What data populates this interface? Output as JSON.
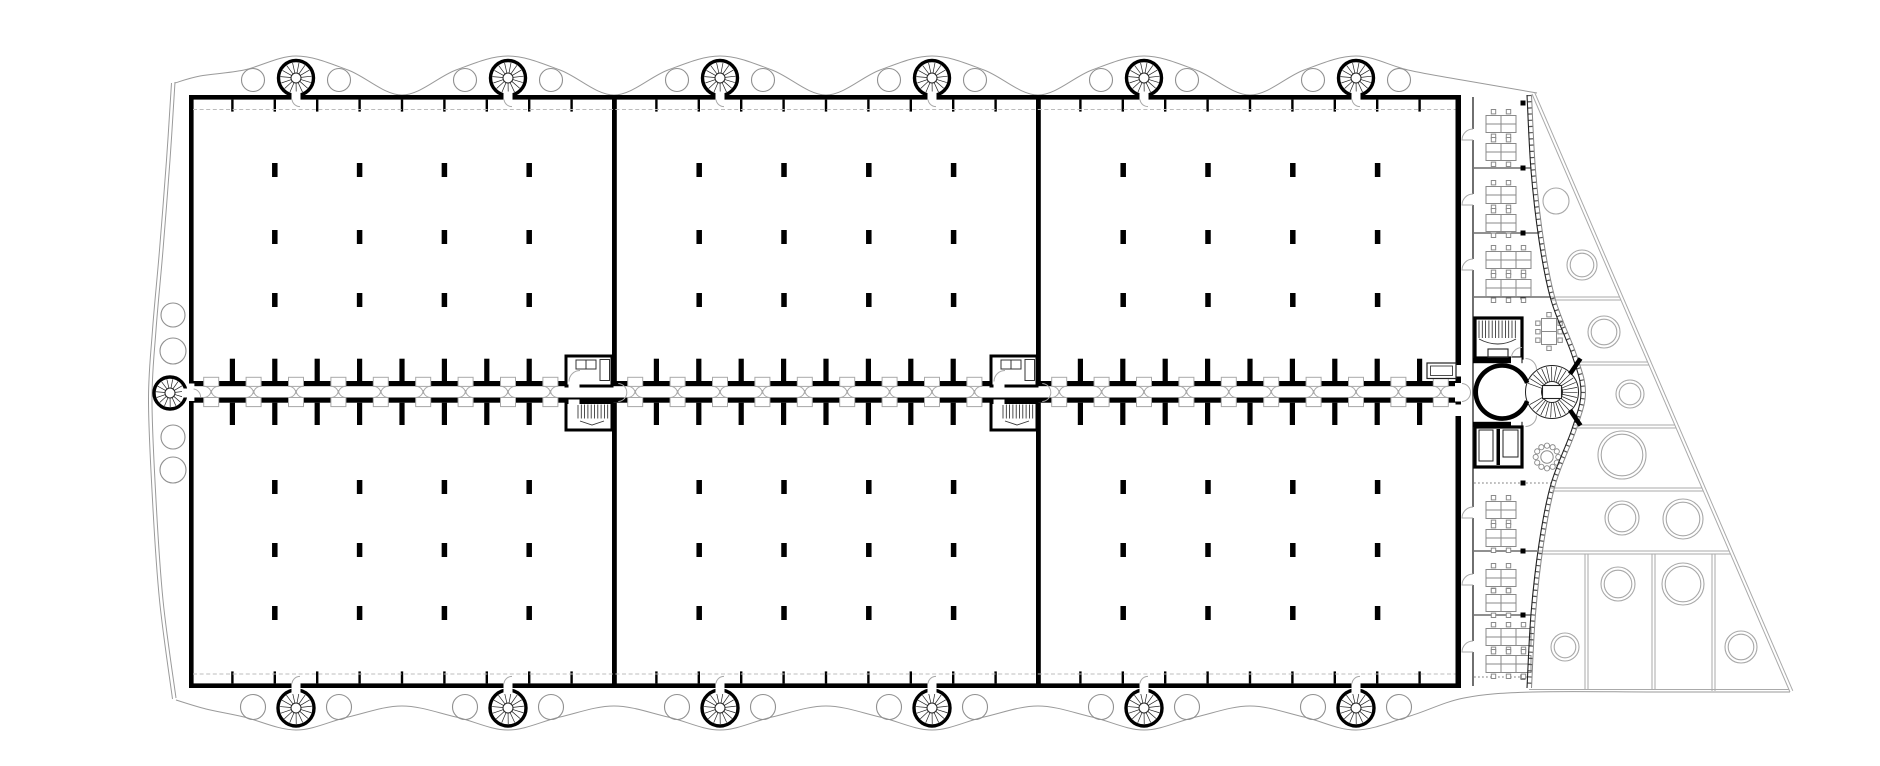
{
  "drawing": {
    "kind": "architectural-floor-plan",
    "canvas": {
      "w": 1880,
      "h": 766,
      "bg": "#ffffff"
    },
    "colors": {
      "wall": "#000000",
      "thin_line": "#222222",
      "fixture": "#333333",
      "door": "#a8a8a8",
      "furniture": "#8a8a8a",
      "landscape": "#9a9a9a",
      "tree_circle": "#909090",
      "plot_circle": "#a8a8a8",
      "dashed": "#bcbcbc",
      "dotted": "#808080",
      "facade_dark": "#222222",
      "facade_mid": "#555555",
      "facade_light": "#888888"
    },
    "grid": {
      "x0": 190,
      "spacing": 42.4,
      "bays": 30
    },
    "shell": {
      "left": 189,
      "right": 1458,
      "top": 95,
      "bottom": 688,
      "wall_t": 4.6,
      "east_wall_x": 1455.5,
      "east_wall_t": 5.5,
      "dividers_x": [
        612,
        1036
      ],
      "divider_t": 4.8,
      "tick_len": 12,
      "tick_w": 2.4,
      "dash_top_y": 109.5,
      "dash_bottom_y": 674
    },
    "corridor": {
      "wall_top_y": 381,
      "wall_bot_y": 397.5,
      "wall_t": 5.2,
      "stub_len": 22.3,
      "stub_w": 5.2,
      "door_half_w": 7.5,
      "skip_door_bays": [
        9,
        19
      ],
      "skip_stub_idx": [
        9,
        10,
        19,
        20
      ],
      "west_opening": {
        "x": 188.2,
        "y": 383.5,
        "w": 6.2,
        "h": 17.5
      }
    },
    "columns": {
      "w": 5.5,
      "h": 14,
      "rows_y": [
        170,
        237,
        300,
        487,
        550,
        613
      ],
      "grid_offsets": [
        2,
        4,
        6,
        8
      ],
      "hall_origins_x": [
        190,
        614.4,
        1038.4
      ]
    },
    "cores": {
      "x_list": [
        566,
        991
      ],
      "w": 46,
      "room_y": 356,
      "room_h": 30,
      "stair_y": 402.5,
      "stair_h": 27.5
    },
    "east_wing": {
      "strip_wall_x": 1473,
      "dots_x": 1520.5,
      "dots_y": [
        103,
        168,
        233,
        297,
        483,
        551,
        615,
        677
      ],
      "partitions": [
        {
          "y": 168,
          "x2": 1531.5
        },
        {
          "y": 233,
          "x2": 1539.5
        },
        {
          "y": 297,
          "x2": 1551
        },
        {
          "y": 551,
          "x2": 1537
        },
        {
          "y": 615,
          "x2": 1531
        }
      ],
      "dotted_partitions": [
        {
          "y": 483,
          "x2": 1551
        },
        {
          "y": 677,
          "x2": 1529
        }
      ],
      "rooms": [
        {
          "y0": 97,
          "y1": 168,
          "door_y": 140,
          "desks": [
            {
              "cy": 124,
              "u": 2
            },
            {
              "cy": 152,
              "u": 2
            }
          ]
        },
        {
          "y0": 168,
          "y1": 233,
          "door_y": 205,
          "desks": [
            {
              "cy": 195,
              "u": 2
            },
            {
              "cy": 223,
              "u": 2
            }
          ]
        },
        {
          "y0": 233,
          "y1": 297,
          "door_y": 270,
          "desks": [
            {
              "cy": 260,
              "u": 3
            },
            {
              "cy": 288,
              "u": 3
            }
          ]
        },
        {
          "y0": 483,
          "y1": 551,
          "door_y": 518,
          "desks": [
            {
              "cy": 510,
              "u": 2
            },
            {
              "cy": 538,
              "u": 2
            }
          ]
        },
        {
          "y0": 551,
          "y1": 615,
          "door_y": 585,
          "desks": [
            {
              "cy": 578,
              "u": 2
            },
            {
              "cy": 603,
              "u": 2
            }
          ]
        },
        {
          "y0": 615,
          "y1": 677,
          "door_y": 652,
          "desks": [
            {
              "cy": 637,
              "u": 3
            },
            {
              "cy": 664,
              "u": 3
            }
          ]
        }
      ],
      "stair_room": {
        "x": 1475,
        "y": 318,
        "w": 47,
        "h": 40
      },
      "wc_room": {
        "x": 1475,
        "y": 427,
        "w": 47,
        "h": 40
      },
      "lobby": {
        "wall_x": 1473,
        "wall_w": 49.5,
        "top_y": 358,
        "bot_y": 421.8,
        "wall_t": 5.2
      },
      "booth": {
        "x": 1427,
        "y": 363,
        "w": 29,
        "h": 15.5
      },
      "table8": {
        "x": 1541.5,
        "y": 318.5,
        "w": 15,
        "h": 26
      },
      "table12": {
        "cx": 1547,
        "cy": 457,
        "r_table": 6.2,
        "r_ring": 11.3,
        "r_chair": 2.6,
        "n": 12
      },
      "spiral": {
        "cx": 1552,
        "cy": 392,
        "r_out": 26.5,
        "r_in": 10.5,
        "lift": {
          "x": 1542.5,
          "y": 385.5,
          "w": 19,
          "h": 13
        }
      },
      "facade_pts": [
        [
          1527,
          95
        ],
        [
          1531,
          170
        ],
        [
          1539,
          240
        ],
        [
          1551,
          300
        ],
        [
          1572,
          355
        ],
        [
          1581,
          392
        ],
        [
          1572,
          429
        ],
        [
          1551,
          484
        ],
        [
          1539,
          544
        ],
        [
          1531,
          614
        ],
        [
          1527,
          688
        ]
      ]
    },
    "landscape": {
      "top_wave": [
        [
          175,
          83
        ],
        [
          200,
          76
        ],
        [
          244,
          70
        ],
        [
          296,
          56
        ],
        [
          348,
          70
        ],
        [
          402,
          95
        ],
        [
          456,
          70
        ],
        [
          508,
          56
        ],
        [
          560,
          70
        ],
        [
          614,
          95
        ],
        [
          668,
          70
        ],
        [
          720,
          56
        ],
        [
          772,
          70
        ],
        [
          826,
          95
        ],
        [
          880,
          70
        ],
        [
          932,
          56
        ],
        [
          984,
          70
        ],
        [
          1038,
          95
        ],
        [
          1092,
          70
        ],
        [
          1144,
          56
        ],
        [
          1196,
          70
        ],
        [
          1250,
          95
        ],
        [
          1304,
          70
        ],
        [
          1356,
          56
        ],
        [
          1408,
          70
        ],
        [
          1462,
          80
        ],
        [
          1537,
          93
        ]
      ],
      "bottom_wave": [
        [
          176,
          700
        ],
        [
          206,
          709
        ],
        [
          244,
          717
        ],
        [
          296,
          730
        ],
        [
          348,
          717
        ],
        [
          402,
          706
        ],
        [
          456,
          717
        ],
        [
          508,
          730
        ],
        [
          560,
          717
        ],
        [
          614,
          706
        ],
        [
          668,
          717
        ],
        [
          720,
          730
        ],
        [
          772,
          717
        ],
        [
          826,
          706
        ],
        [
          880,
          717
        ],
        [
          932,
          730
        ],
        [
          984,
          717
        ],
        [
          1038,
          706
        ],
        [
          1092,
          717
        ],
        [
          1144,
          730
        ],
        [
          1196,
          717
        ],
        [
          1250,
          706
        ],
        [
          1304,
          717
        ],
        [
          1356,
          730
        ],
        [
          1410,
          716
        ],
        [
          1464,
          698
        ],
        [
          1533,
          692
        ],
        [
          1660,
          692
        ],
        [
          1790,
          692
        ]
      ],
      "left_strip_outer": [
        [
          175,
          82
        ],
        [
          170,
          160
        ],
        [
          163,
          250
        ],
        [
          156,
          330
        ],
        [
          152,
          400
        ],
        [
          156,
          500
        ],
        [
          163,
          600
        ],
        [
          176,
          698
        ]
      ],
      "left_strip_inner": [
        [
          171.5,
          83
        ],
        [
          166.5,
          160
        ],
        [
          159.5,
          250
        ],
        [
          152.5,
          330
        ],
        [
          148.5,
          400
        ],
        [
          152.5,
          500
        ],
        [
          159.5,
          600
        ],
        [
          172.5,
          699
        ]
      ],
      "diagonal": [
        [
          1532,
          94
        ],
        [
          1790,
          692
        ]
      ],
      "diagonal2": [
        [
          1534.8,
          92.8
        ],
        [
          1792.8,
          690.8
        ]
      ],
      "bottom_edge_y": 689.5,
      "plot_h_lines": [
        {
          "y": 297,
          "x1": 1551,
          "x2": 1619.5
        },
        {
          "y": 362,
          "x1": 1574,
          "x2": 1647.5
        },
        {
          "y": 425,
          "x1": 1574,
          "x2": 1674.5
        },
        {
          "y": 488,
          "x1": 1551,
          "x2": 1702
        },
        {
          "y": 551,
          "x1": 1538,
          "x2": 1729
        }
      ],
      "plot_v_lines": [
        {
          "x": 1585,
          "y1": 551,
          "y2": 690
        },
        {
          "x": 1652,
          "y1": 551,
          "y2": 690
        },
        {
          "x": 1712,
          "y1": 551,
          "y2": 691
        }
      ],
      "plot_circles": [
        [
          1556,
          201,
          13
        ],
        [
          1582,
          265,
          15
        ],
        [
          1604,
          332,
          16
        ],
        [
          1630,
          394,
          14
        ],
        [
          1622,
          455,
          24
        ],
        [
          1622,
          518,
          17
        ],
        [
          1683,
          519,
          20
        ],
        [
          1565,
          647,
          14
        ],
        [
          1618,
          584,
          17
        ],
        [
          1683,
          584,
          21
        ],
        [
          1741,
          647,
          16
        ]
      ],
      "left_circles": [
        [
          173,
          315,
          12
        ],
        [
          173,
          351,
          13
        ],
        [
          173,
          437,
          12
        ],
        [
          173,
          470,
          13
        ]
      ],
      "stair_towers": {
        "top": {
          "xs": [
            296,
            508,
            720,
            932,
            1144,
            1356
          ],
          "y": 78,
          "r": 17.5
        },
        "bottom": {
          "xs": [
            296,
            508,
            720,
            932,
            1144,
            1356
          ],
          "y": 708,
          "r": 18
        },
        "west": {
          "x": 170,
          "y": 393,
          "r": 16
        },
        "flank_dx": 43,
        "flank_r_top": 11.5,
        "flank_r_bottom": 12.5
      }
    }
  }
}
